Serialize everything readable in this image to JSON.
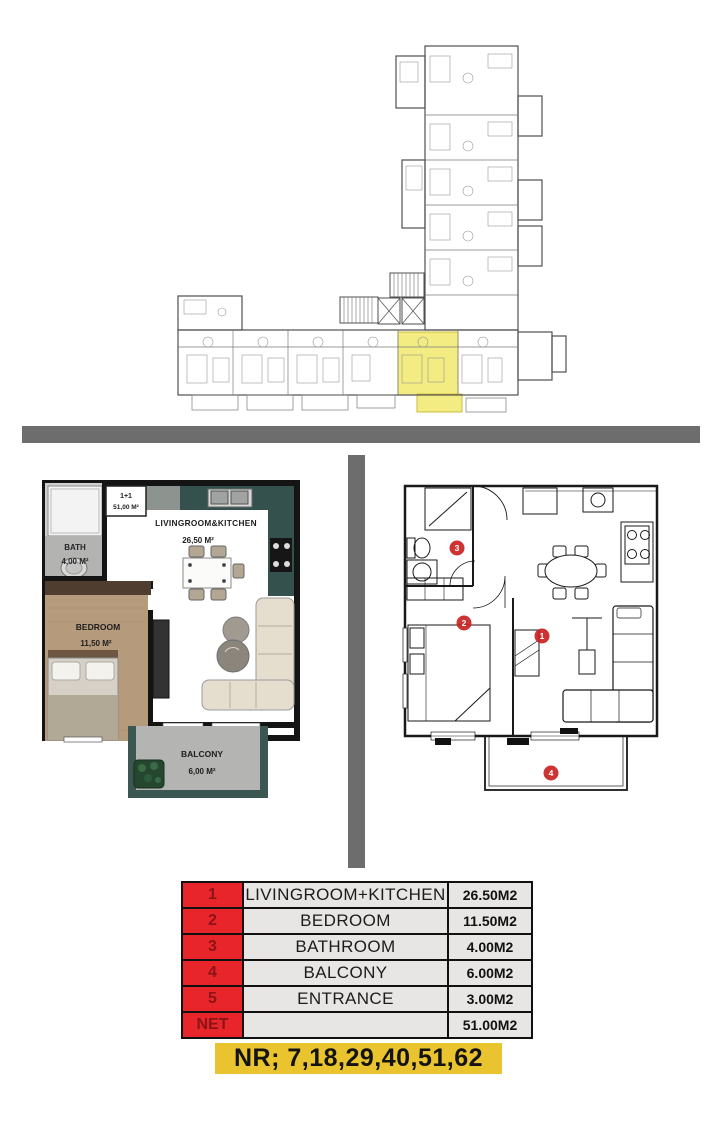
{
  "overview_plan": {
    "highlight_color": "#f2ec82",
    "highlighted_unit": "1+1 unit location"
  },
  "dividers": {
    "color": "#6d6d6d"
  },
  "left_plan": {
    "unit_label": "1+1",
    "unit_area": "51,00 M²",
    "living_name": "LIVINGROOM&KITCHEN",
    "living_area": "26,50 M²",
    "bath_name": "BATH",
    "bath_area": "4,00 M²",
    "bedroom_name": "BEDROOM",
    "bedroom_area": "11,50 M²",
    "balcony_name": "BALCONY",
    "balcony_area": "6,00 M²"
  },
  "right_plan": {
    "marker_color": "#c81d1d",
    "markers": [
      "1",
      "2",
      "3",
      "4"
    ]
  },
  "area_table": {
    "number_bg": "#e8252b",
    "number_text_color": "#8b1416",
    "rows": [
      {
        "num": "1",
        "room": "LIVINGROOM+KITCHEN",
        "area": "26.50M2"
      },
      {
        "num": "2",
        "room": "BEDROOM",
        "area": "11.50M2"
      },
      {
        "num": "3",
        "room": "BATHROOM",
        "area": "4.00M2"
      },
      {
        "num": "4",
        "room": "BALCONY",
        "area": "6.00M2"
      },
      {
        "num": "5",
        "room": "ENTRANCE",
        "area": "3.00M2"
      },
      {
        "num": "NET",
        "room": "",
        "area": "51.00M2"
      }
    ]
  },
  "nr_label": {
    "bg": "#e9c42e",
    "text": "NR; 7,18,29,40,51,62"
  }
}
